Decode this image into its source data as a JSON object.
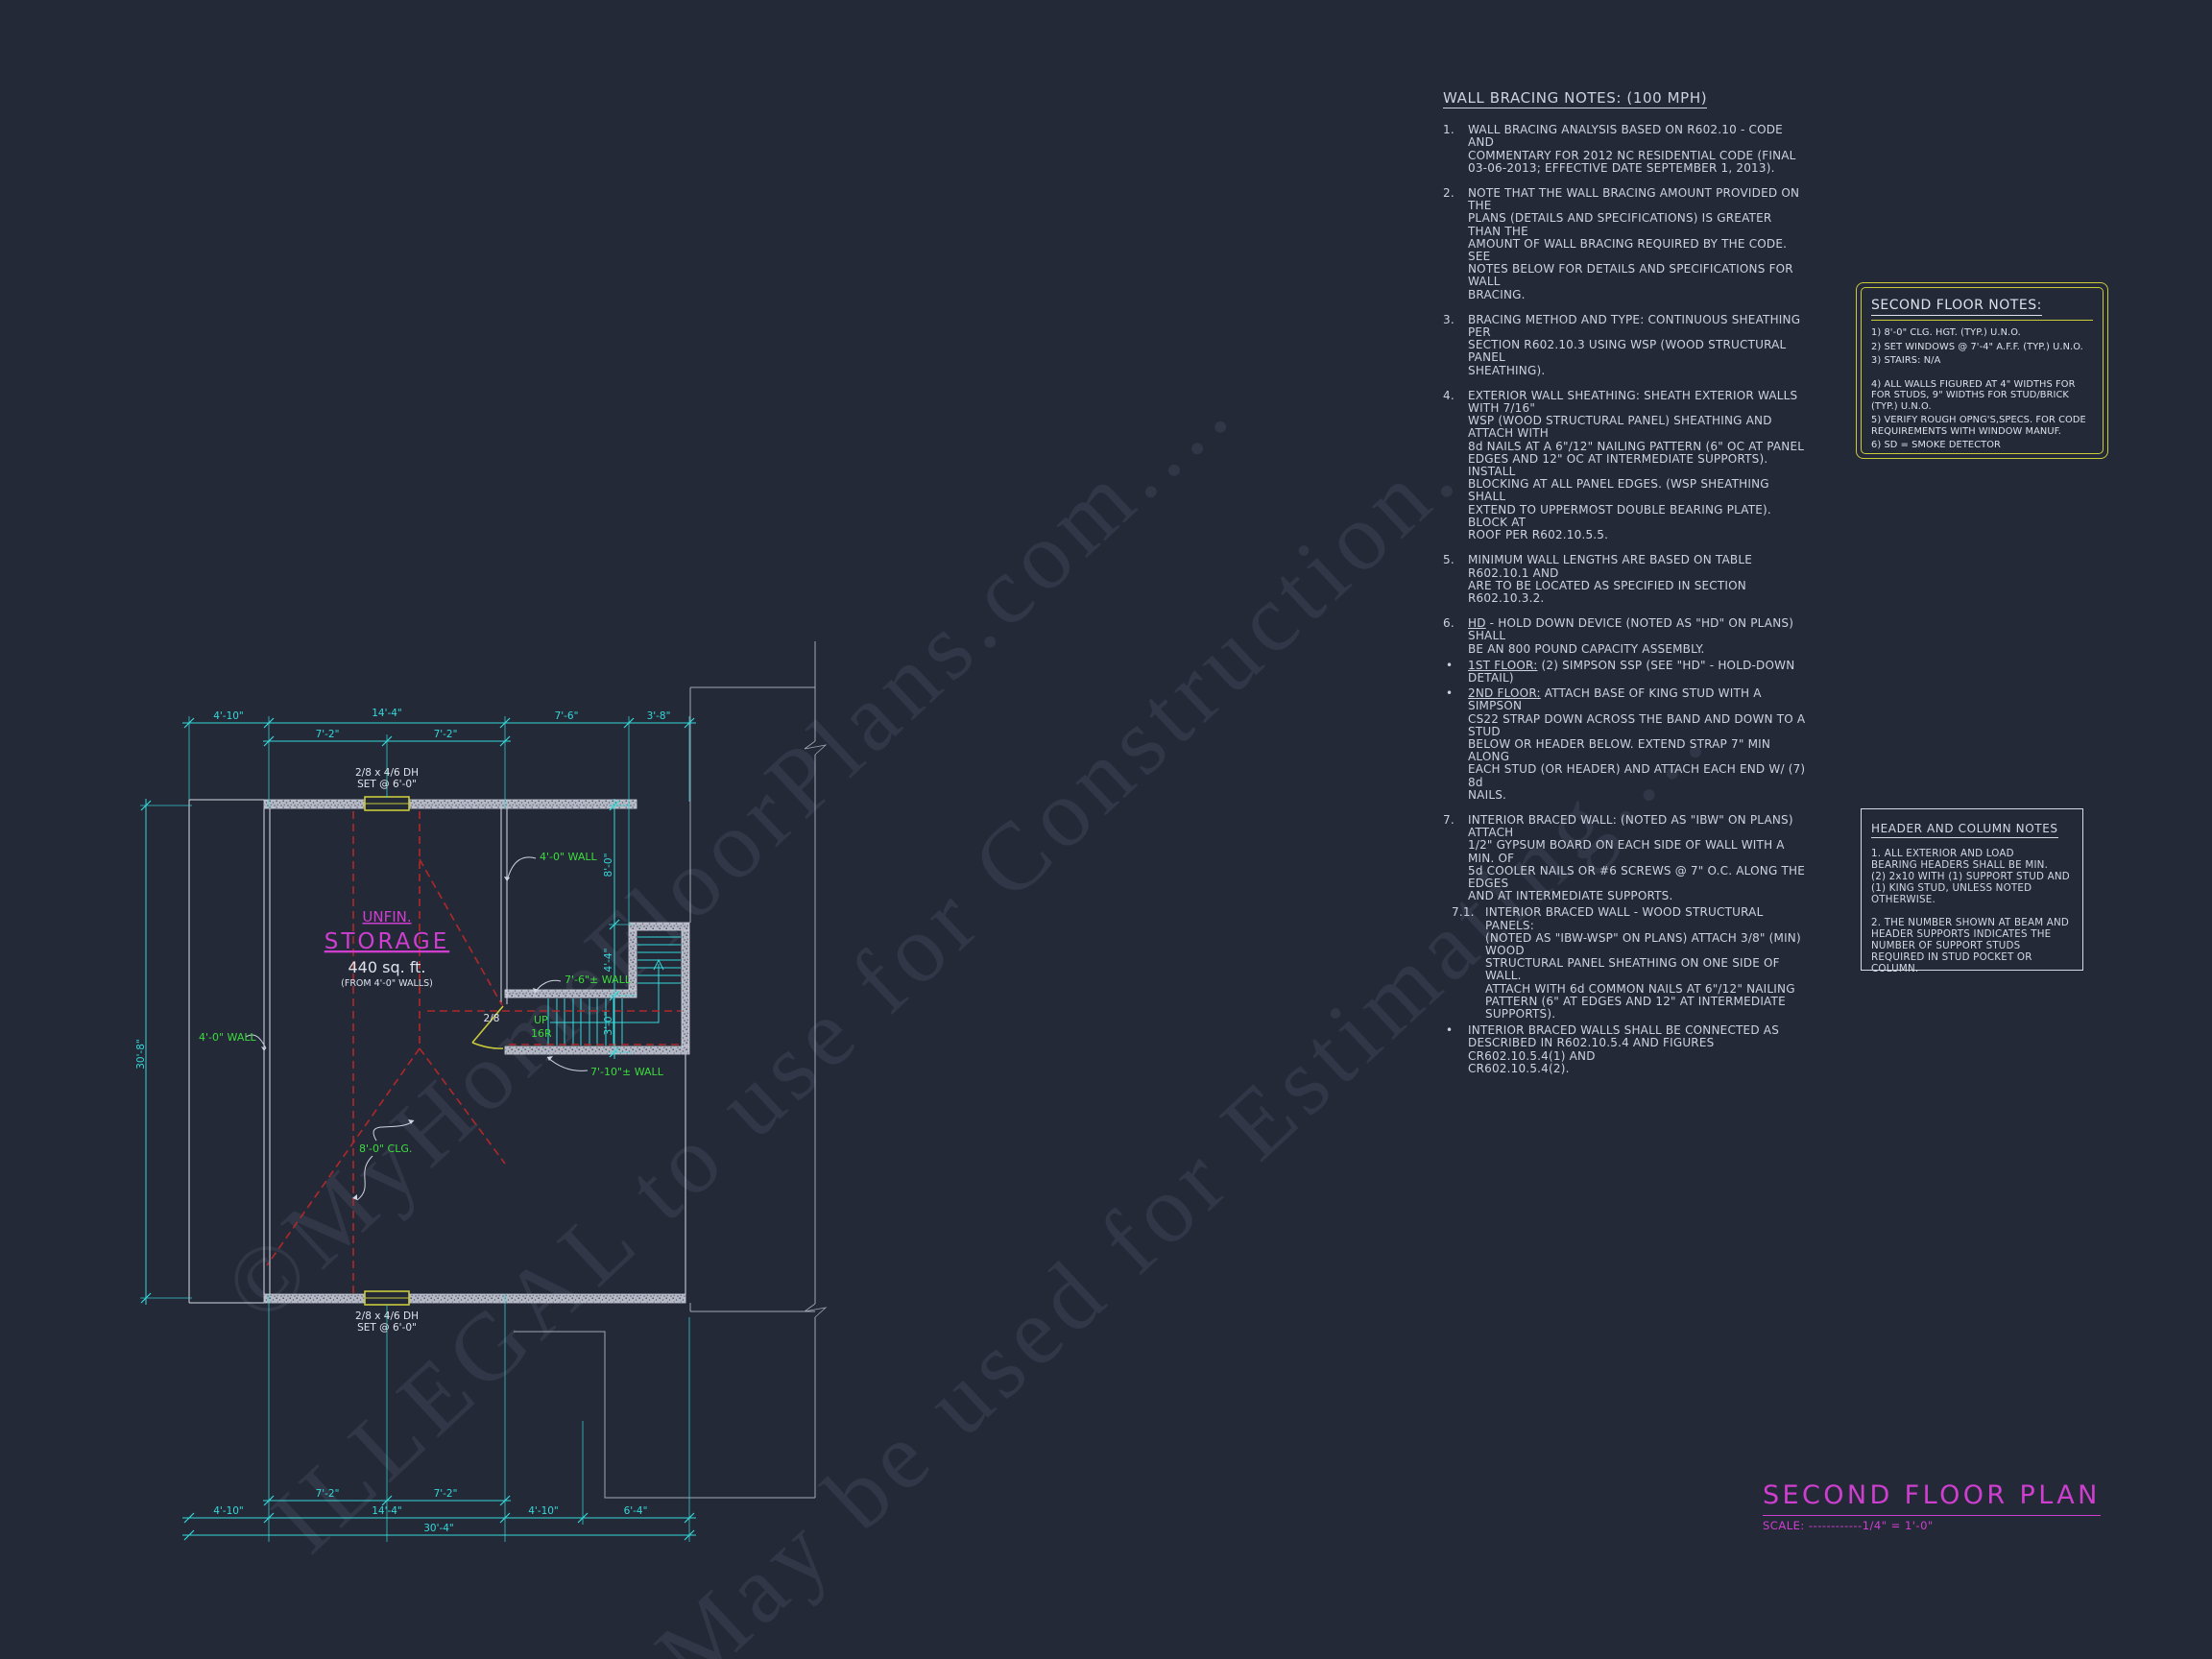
{
  "watermark": {
    "line1": "©MyHomeFloorPlans.com....",
    "line2": "ILLEGAL to use for Construction.",
    "line3": "May be used for Estimating...."
  },
  "wall_bracing": {
    "heading": "WALL BRACING NOTES: (100 MPH)",
    "n1": "1.",
    "n2": "2.",
    "n3": "3.",
    "n4": "4.",
    "n5": "5.",
    "n6": "6.",
    "n7": "7.",
    "n71": "7.1.",
    "bullet": "•",
    "i1": "WALL BRACING ANALYSIS BASED ON R602.10 - CODE AND\nCOMMENTARY FOR 2012 NC RESIDENTIAL CODE (FINAL\n03-06-2013; EFFECTIVE DATE SEPTEMBER 1, 2013).",
    "i2": "NOTE THAT THE WALL BRACING AMOUNT PROVIDED ON THE\nPLANS (DETAILS AND SPECIFICATIONS) IS GREATER THAN THE\nAMOUNT OF WALL BRACING REQUIRED BY THE CODE. SEE\nNOTES BELOW FOR DETAILS AND SPECIFICATIONS FOR WALL\nBRACING.",
    "i3": "BRACING METHOD AND TYPE: CONTINUOUS SHEATHING PER\nSECTION R602.10.3 USING WSP (WOOD STRUCTURAL PANEL\nSHEATHING).",
    "i4": "EXTERIOR WALL SHEATHING: SHEATH EXTERIOR WALLS WITH 7/16\"\nWSP (WOOD STRUCTURAL PANEL) SHEATHING AND ATTACH WITH\n8d NAILS AT A 6\"/12\" NAILING PATTERN (6\" OC AT PANEL\nEDGES AND 12\" OC AT INTERMEDIATE SUPPORTS). INSTALL\nBLOCKING AT ALL PANEL EDGES. (WSP SHEATHING SHALL\nEXTEND TO UPPERMOST DOUBLE BEARING PLATE). BLOCK AT\nROOF PER R602.10.5.5.",
    "i5": "MINIMUM WALL LENGTHS ARE BASED ON TABLE R602.10.1 AND\nARE TO BE LOCATED AS SPECIFIED IN SECTION R602.10.3.2.",
    "hd_label": "HD",
    "hd_rest": " - HOLD DOWN DEVICE (NOTED AS \"HD\" ON PLANS) SHALL\nBE AN 800 POUND CAPACITY ASSEMBLY.",
    "b1_label": "1ST FLOOR:",
    "b1_rest": " (2) SIMPSON SSP (SEE \"HD\" - HOLD-DOWN DETAIL)",
    "b2_label": "2ND FLOOR:",
    "b2_rest": " ATTACH BASE OF KING STUD WITH A SIMPSON\nCS22 STRAP DOWN ACROSS THE BAND AND DOWN TO A STUD\nBELOW OR HEADER BELOW.  EXTEND STRAP 7\" MIN ALONG\nEACH STUD (OR HEADER) AND ATTACH EACH END W/ (7) 8d\nNAILS.",
    "i7": "INTERIOR BRACED WALL: (NOTED AS \"IBW\" ON PLANS) ATTACH\n1/2\" GYPSUM BOARD ON EACH SIDE OF WALL WITH A MIN. OF\n5d COOLER NAILS OR #6 SCREWS @ 7\" O.C. ALONG THE EDGES\nAND AT INTERMEDIATE SUPPORTS.",
    "i71": "INTERIOR BRACED WALL - WOOD STRUCTURAL PANELS:\n(NOTED AS \"IBW-WSP\" ON PLANS) ATTACH 3/8\" (MIN) WOOD\nSTRUCTURAL PANEL SHEATHING ON ONE SIDE OF WALL.\nATTACH WITH 6d COMMON NAILS AT 6\"/12\" NAILING\nPATTERN (6\" AT EDGES AND 12\" AT INTERMEDIATE\nSUPPORTS).",
    "last": "INTERIOR BRACED WALLS SHALL BE CONNECTED AS\nDESCRIBED IN R602.10.5.4 AND FIGURES CR602.10.5.4(1) AND\nCR602.10.5.4(2)."
  },
  "second_floor_notes": {
    "title": "SECOND FLOOR NOTES:",
    "i1": "1) 8'-0\"  CLG. HGT. (TYP.) U.N.O.",
    "i2": "2) SET WINDOWS @ 7'-4\" A.F.F. (TYP.) U.N.O.",
    "i3": "3) STAIRS: N/A",
    "i4": "4) ALL WALLS FIGURED AT 4\" WIDTHS FOR\n     FOR STUDS, 9\" WIDTHS FOR STUD/BRICK\n     (TYP.) U.N.O.",
    "i5": "5) VERIFY ROUGH OPNG'S,SPECS. FOR CODE\n     REQUIREMENTS WITH WINDOW MANUF.",
    "i6": "6) SD = SMOKE DETECTOR"
  },
  "header_notes": {
    "title": "HEADER AND COLUMN NOTES",
    "p1": "1. ALL EXTERIOR AND LOAD\nBEARING HEADERS SHALL BE MIN.\n(2) 2x10 WITH (1) SUPPORT STUD AND\n(1) KING STUD, UNLESS NOTED\nOTHERWISE.",
    "p2": "2. THE NUMBER SHOWN AT BEAM AND\nHEADER SUPPORTS INDICATES THE\nNUMBER OF SUPPORT STUDS\nREQUIRED IN STUD POCKET OR\nCOLUMN."
  },
  "titleblock": {
    "title": "SECOND FLOOR PLAN",
    "scale": "SCALE: ------------1/4\" = 1'-0\""
  },
  "plan": {
    "colors": {
      "background": "#242938",
      "dimension_cyan": "#35d8d8",
      "label_green": "#3cdc3c",
      "ceiling_red": "#b02828",
      "room_magenta": "#cf3fcf",
      "window_yellow": "#c9cb3a",
      "line_white": "#d6dae6"
    },
    "dims": {
      "d_4_10": "4'-10\"",
      "d_14_4": "14'-4\"",
      "d_7_6": "7'-6\"",
      "d_3_8": "3'-8\"",
      "d_7_2": "7'-2\"",
      "d_6_4": "6'-4\"",
      "d_30_4": "30'-4\"",
      "d_30_8": "30'-8\"",
      "d_8_0": "8'-0\"",
      "d_4_4": "4'-4\"",
      "d_3_0": "3'-0\""
    },
    "labels": {
      "unfin": "UNFIN.",
      "storage": "STORAGE",
      "area": "440 sq. ft.",
      "area_from": "(FROM 4'-0\" WALLS)",
      "wall40": "4'-0\" WALL",
      "wall76": "7'-6\"± WALL",
      "wall710": "7'-10\"± WALL",
      "clg": "8'-0\" CLG.",
      "up": "UP",
      "risers": "16R",
      "win1": "2/8 x 4/6 DH",
      "win2": "SET @ 6'-0\"",
      "door": "2/8"
    }
  }
}
